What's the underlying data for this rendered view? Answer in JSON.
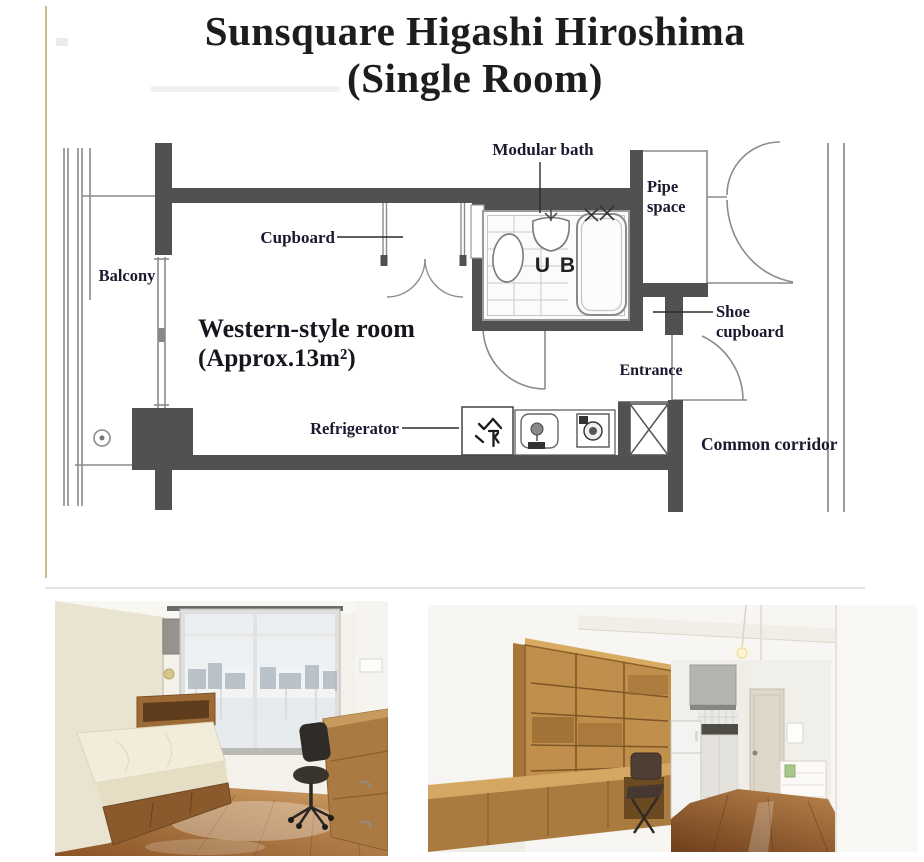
{
  "title": {
    "line1": "Sunsquare Higashi Hiroshima",
    "line2": "(Single Room)"
  },
  "floor_plan": {
    "labels": {
      "balcony": "Balcony",
      "cupboard": "Cupboard",
      "modular_bath": "Modular bath",
      "pipe_space_line1": "Pipe",
      "pipe_space_line2": "space",
      "unit_bath": "U B",
      "shoe_cupboard_line1": "Shoe",
      "shoe_cupboard_line2": "cupboard",
      "room_name": "Western-style room",
      "room_area": "(Approx.13m²)",
      "entrance": "Entrance",
      "refrigerator": "Refrigerator",
      "refrigerator_kanji": "冷",
      "common_corridor": "Common corridor"
    },
    "colors": {
      "wall": "#515151",
      "thin_line": "#8b8b8b",
      "label_text": "#191930",
      "left_rule": "#c9bc8d"
    }
  }
}
